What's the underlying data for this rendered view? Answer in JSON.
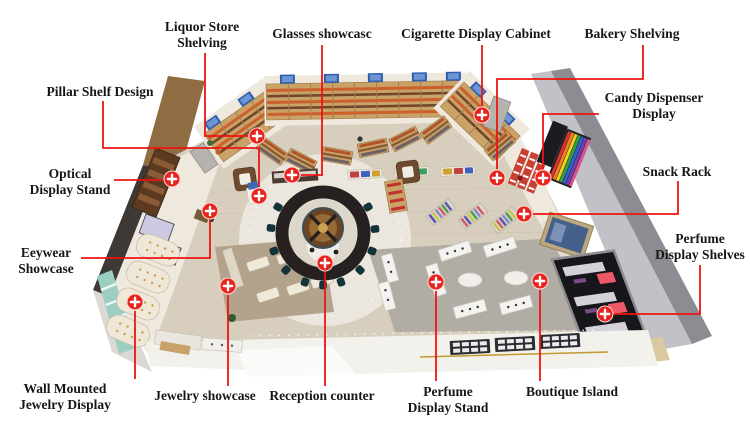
{
  "annotations": {
    "line_color": "#ee1411",
    "marker_fill": "#e8231d",
    "marker_icon": "plus",
    "label_text_color": "#161616",
    "labels": [
      {
        "id": "liquor-store-shelving",
        "lines": [
          "Liquor Store",
          "Shelving"
        ]
      },
      {
        "id": "glasses-showcase",
        "lines": [
          "Glasses showcasc"
        ]
      },
      {
        "id": "cigarette-display-cabinet",
        "lines": [
          "Cigarette Display Cabinet"
        ]
      },
      {
        "id": "bakery-shelving",
        "lines": [
          "Bakery Shelving"
        ]
      },
      {
        "id": "candy-dispenser-display",
        "lines": [
          "Candy Dispenser",
          "Display"
        ]
      },
      {
        "id": "snack-rack",
        "lines": [
          "Snack Rack"
        ]
      },
      {
        "id": "perfume-display-shelves",
        "lines": [
          "Perfume",
          "Display Shelves"
        ]
      },
      {
        "id": "pillar-shelf-design",
        "lines": [
          "Pillar Shelf Design"
        ]
      },
      {
        "id": "optical-display-stand",
        "lines": [
          "Optical",
          "Display Stand"
        ]
      },
      {
        "id": "eyewear-showcase",
        "lines": [
          "Eeywear",
          "Showcase"
        ]
      },
      {
        "id": "wall-mounted-jewelry-display",
        "lines": [
          "Wall Mounted",
          "Jewelry Display"
        ]
      },
      {
        "id": "jewelry-showcase",
        "lines": [
          "Jewelry showcase"
        ]
      },
      {
        "id": "reception-counter",
        "lines": [
          "Reception counter"
        ]
      },
      {
        "id": "perfume-display-stand",
        "lines": [
          "Perfume",
          "Display Stand"
        ]
      },
      {
        "id": "boutique-island",
        "lines": [
          "Boutique Island"
        ]
      }
    ]
  }
}
